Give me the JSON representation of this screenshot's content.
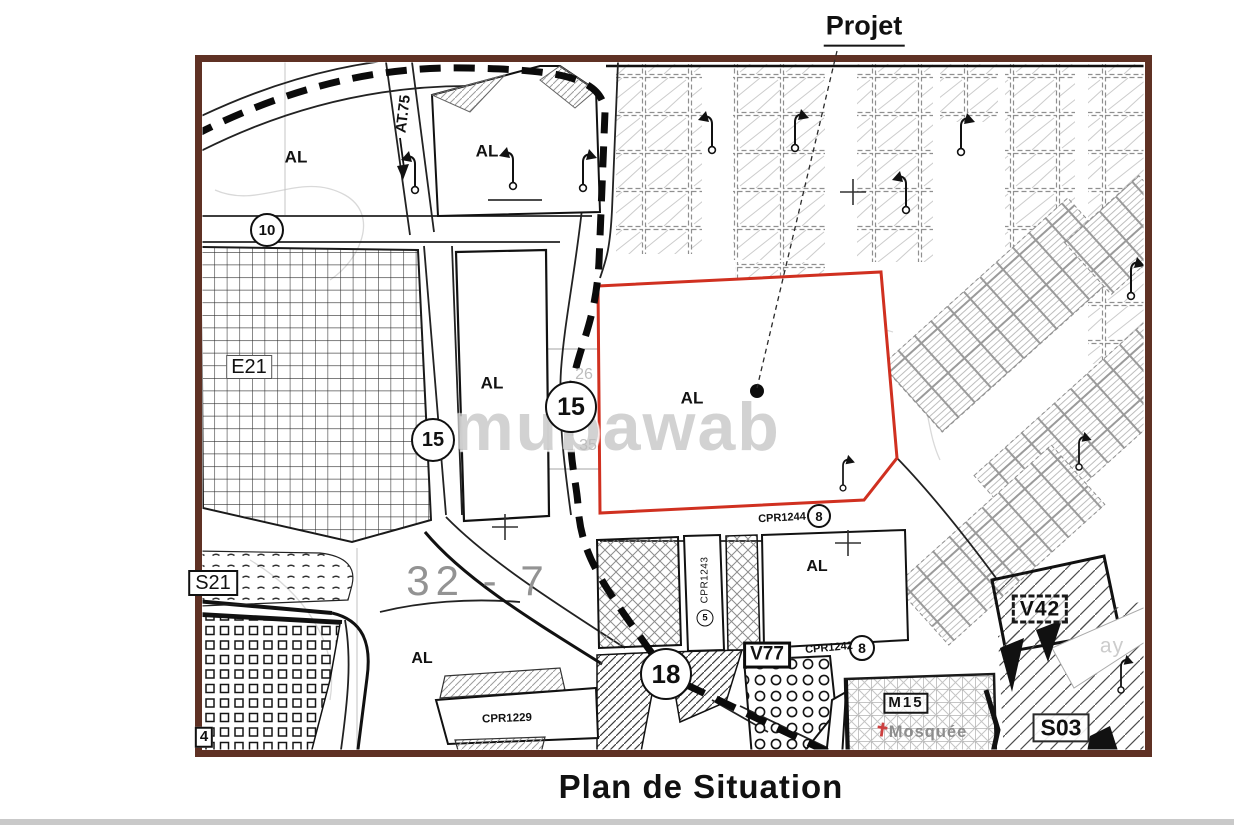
{
  "header": {
    "project_label": "Projet"
  },
  "footer": {
    "caption": "Plan de Situation"
  },
  "watermark": {
    "text": "mubawab"
  },
  "map": {
    "zone_labels": {
      "al": "AL",
      "e21": "E21",
      "s21": "S21",
      "sector_32_7": "32 - 7",
      "partial_4": "4"
    },
    "street_labels": {
      "at75": "AT.75",
      "faint_ay": "ay"
    },
    "road_markers": {
      "m10": "10",
      "m15": "15",
      "m18": "18",
      "m8": "8",
      "m5": "5"
    },
    "parcel_refs": {
      "cpr1244": "CPR1244",
      "cpr1243": "CPR1243",
      "cpr1242": "CPR1242",
      "cpr1229": "CPR1229"
    },
    "box_labels": {
      "v77": "V77",
      "v42": "V42",
      "s03": "S03",
      "m15": "M15"
    },
    "poi": {
      "mosque": "Mosquée"
    },
    "faint_numbers": {
      "n26": "26",
      "n35": "35"
    },
    "glyphs": {
      "mosque": "✝"
    },
    "icons": {
      "project_marker": "project-location-dot",
      "mosque_marker": "mosque-cross-icon",
      "street_lamp": "street-lamp-icon",
      "direction_arrow": "down-arrow-icon"
    },
    "colors": {
      "frame": "#5f3124",
      "project_parcel_outline": "#d03020",
      "mosque_marker_color": "#cc4040",
      "watermark_gray": "#bdbdbd"
    }
  }
}
